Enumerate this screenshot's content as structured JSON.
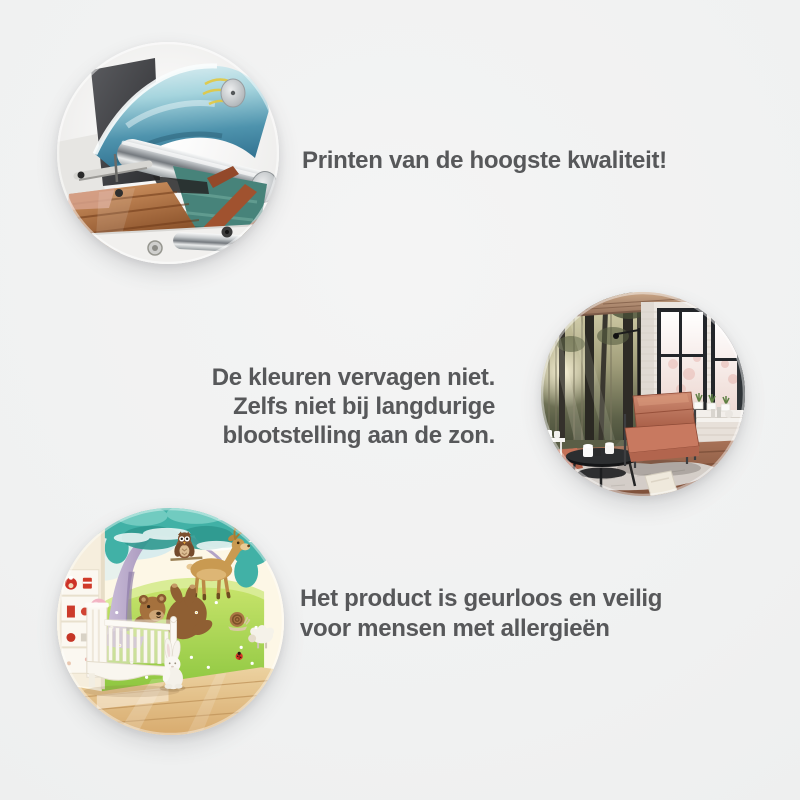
{
  "colors": {
    "background": "#f1f2f2",
    "text": "#57585a"
  },
  "features": [
    {
      "photo_label": "printer-closeup-photo",
      "lines": [
        "Printen van de hoogste kwaliteit!"
      ]
    },
    {
      "photo_label": "living-room-forest-wall-mural-photo",
      "lines": [
        "De kleuren vervagen niet.",
        "Zelfs niet bij langdurige",
        "blootstelling aan de zon."
      ]
    },
    {
      "photo_label": "nursery-cartoon-wall-mural-photo",
      "lines": [
        "Het product is geurloos en veilig",
        "voor mensen met allergieën"
      ]
    }
  ]
}
